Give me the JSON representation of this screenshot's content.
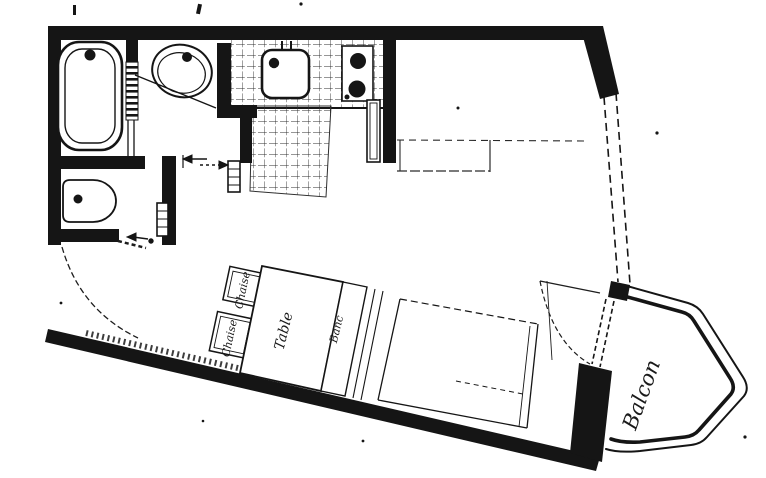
{
  "labels": {
    "chair_upper": "Chaise",
    "chair_lower": "Chaise",
    "table": "Table",
    "bench": "Banc",
    "balcony": "Balcon"
  },
  "fixtures": [
    "bathtub",
    "washbasin",
    "toilet",
    "kitchen-sink",
    "stove-two-burners",
    "radiator",
    "fridge-or-counter",
    "bed",
    "table",
    "chairs",
    "bench",
    "entrance-door-swing",
    "balcony-door-swing",
    "balcony"
  ],
  "colors": {
    "ink": "#151515",
    "paper": "#ffffff",
    "tile_line": "#2e2e2e"
  }
}
